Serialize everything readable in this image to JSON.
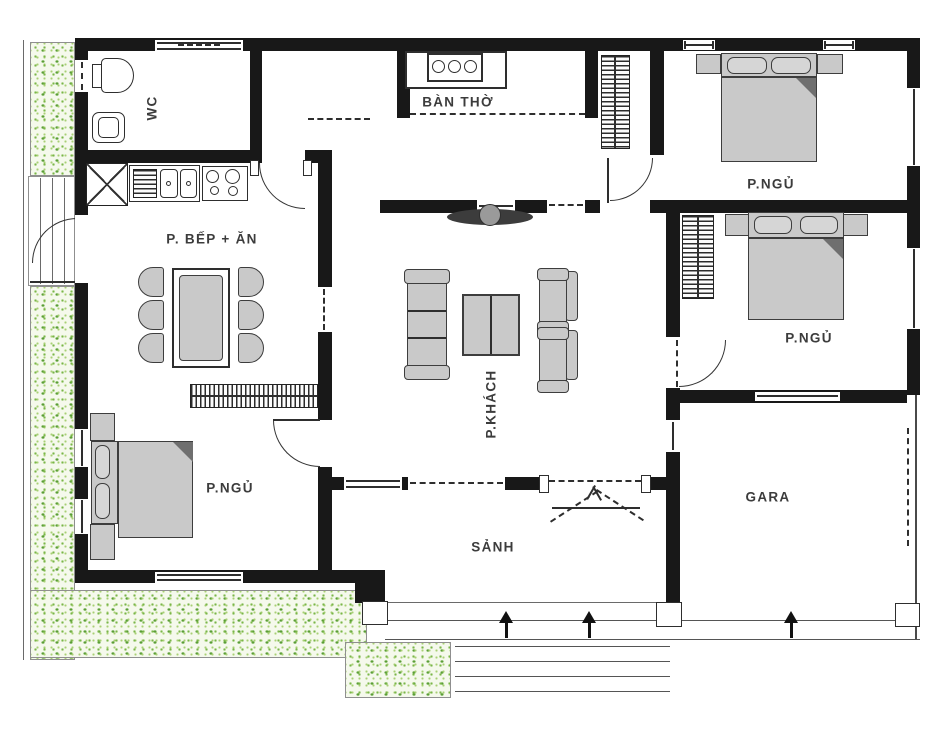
{
  "rooms": {
    "wc": {
      "label": "WC"
    },
    "kitchen_dining": {
      "label": "P. BẾP + ĂN"
    },
    "altar_room": {
      "label": "BÀN THỜ"
    },
    "bedroom_top_right": {
      "label": "P.NGỦ"
    },
    "bedroom_mid_right": {
      "label": "P.NGỦ"
    },
    "bedroom_bottom_left": {
      "label": "P.NGỦ"
    },
    "living_room": {
      "label": "P.KHÁCH"
    },
    "entry_hall": {
      "label": "SẢNH"
    },
    "garage": {
      "label": "GARA"
    }
  },
  "colors": {
    "wall": "#181818",
    "furniture_fill": "#c9c9c9",
    "garden_green": "#7ab648",
    "background": "#ffffff"
  }
}
